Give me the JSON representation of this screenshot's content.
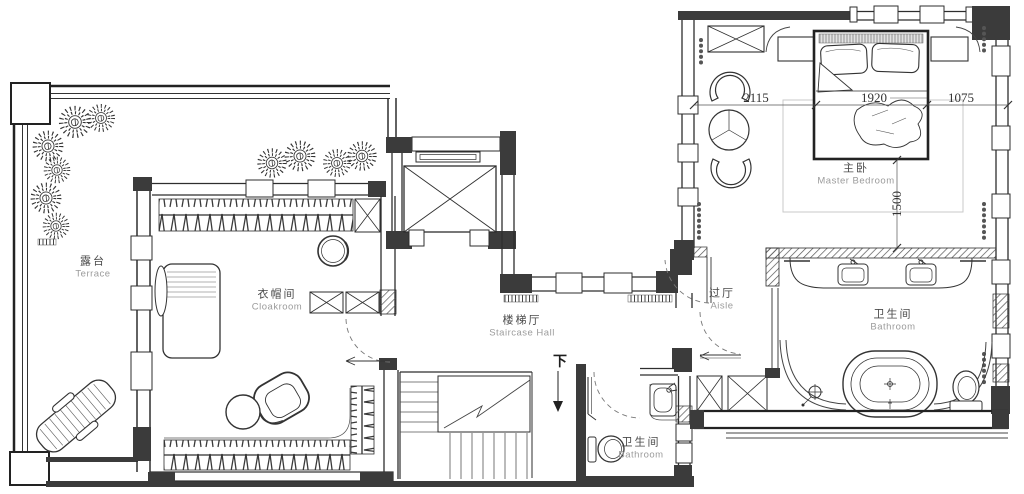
{
  "floor_plan": {
    "rooms": [
      {
        "id": "terrace",
        "name_zh": "露台",
        "name_en": "Terrace"
      },
      {
        "id": "cloakroom",
        "name_zh": "衣帽间",
        "name_en": "Cloakroom"
      },
      {
        "id": "staircase_hall",
        "name_zh": "楼梯厅",
        "name_en": "Staircase Hall"
      },
      {
        "id": "aisle",
        "name_zh": "过厅",
        "name_en": "Aisle"
      },
      {
        "id": "master_bedroom",
        "name_zh": "主卧",
        "name_en": "Master Bedroom"
      },
      {
        "id": "master_bathroom",
        "name_zh": "卫生间",
        "name_en": "Bathroom"
      },
      {
        "id": "guest_bathroom",
        "name_zh": "卫生间",
        "name_en": "Bathroom"
      }
    ],
    "dimensions_mm": [
      {
        "id": "bed_left_clearance",
        "value": "2115"
      },
      {
        "id": "bed_width",
        "value": "1920"
      },
      {
        "id": "bed_right_clearance",
        "value": "1075"
      },
      {
        "id": "bed_foot_clearance",
        "value": "1500"
      }
    ],
    "stair_annotation": {
      "direction_label": "下"
    },
    "colors": {
      "wall_fill": "#3b3b3b",
      "line": "#2e2e2e",
      "label_zh": "#4a4a4a",
      "label_en": "#9b9b9b",
      "dimension_text": "#333333",
      "soft_gray": "#c9c9c9"
    }
  }
}
